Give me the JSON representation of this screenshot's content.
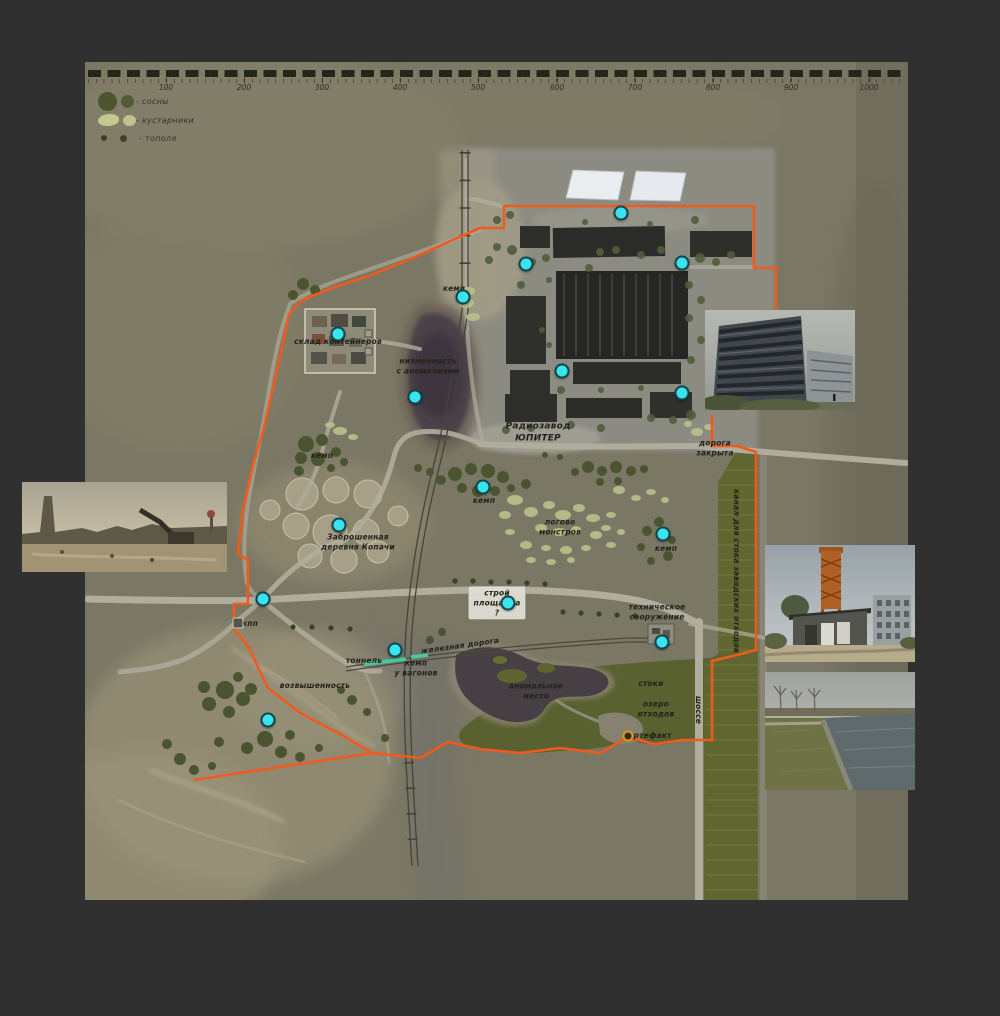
{
  "colors": {
    "background": "#303030",
    "map_base": "#7a7764",
    "boundary_orange": "#f05a1e",
    "poi_cyan": "#3ae4ef",
    "artifact_orange": "#e8920a",
    "canal_green": "#5f662f",
    "lake_dark": "#464044",
    "legend_pine": "#4c5530",
    "legend_shrub": "#c3ca8d",
    "legend_poplar": "#394126"
  },
  "scalebar": {
    "unit_labels": [
      {
        "label": "100",
        "x": 166
      },
      {
        "label": "200",
        "x": 244
      },
      {
        "label": "300",
        "x": 322
      },
      {
        "label": "400",
        "x": 400
      },
      {
        "label": "500",
        "x": 478
      },
      {
        "label": "600",
        "x": 557
      },
      {
        "label": "700",
        "x": 635
      },
      {
        "label": "800",
        "x": 713
      },
      {
        "label": "900",
        "x": 791
      },
      {
        "label": "1000",
        "x": 869
      }
    ]
  },
  "legend": {
    "items": [
      {
        "symbol": "pines",
        "label": "- сосны"
      },
      {
        "symbol": "shrubs",
        "label": "- кустарники"
      },
      {
        "symbol": "poplars",
        "label": "- тополя"
      }
    ]
  },
  "map": {
    "labels": [
      {
        "text": "кемп",
        "x": 454,
        "y": 289
      },
      {
        "text": "склад контейнеров",
        "x": 338,
        "y": 342
      },
      {
        "text": "низменность\nс аномалиями",
        "x": 428,
        "y": 366
      },
      {
        "text": "Радиозавод\nЮПИТЕР",
        "x": 538,
        "y": 433,
        "size": 9,
        "weight": 700
      },
      {
        "text": "дорога\nзакрыта",
        "x": 715,
        "y": 448
      },
      {
        "text": "кемп",
        "x": 322,
        "y": 456
      },
      {
        "text": "кемп",
        "x": 484,
        "y": 501
      },
      {
        "text": "логово\nмонстров",
        "x": 560,
        "y": 527
      },
      {
        "text": "Заброшенная\nдеревня Копачи",
        "x": 358,
        "y": 542
      },
      {
        "text": "кемп",
        "x": 666,
        "y": 549
      },
      {
        "text": "канал для стока заводских отходов",
        "x": 736,
        "y": 571,
        "rot": 90
      },
      {
        "text": "кпп",
        "x": 250,
        "y": 624
      },
      {
        "text": "строй\nплощадка\n?",
        "x": 497,
        "y": 603,
        "box": true
      },
      {
        "text": "техническое\nсооружение",
        "x": 657,
        "y": 612
      },
      {
        "text": "тоннель",
        "x": 364,
        "y": 661
      },
      {
        "text": "железная дорога",
        "x": 460,
        "y": 646,
        "rot": -8
      },
      {
        "text": "кемп\nу вагонов",
        "x": 416,
        "y": 668
      },
      {
        "text": "возвышенность",
        "x": 315,
        "y": 686
      },
      {
        "text": "аномальное\nместо",
        "x": 536,
        "y": 691
      },
      {
        "text": "стоки",
        "x": 651,
        "y": 684
      },
      {
        "text": "озеро\nотходов",
        "x": 656,
        "y": 709
      },
      {
        "text": "артефакт",
        "x": 650,
        "y": 736
      },
      {
        "text": "шоссе",
        "x": 698,
        "y": 710,
        "rot": 90
      }
    ],
    "points": [
      {
        "x": 621,
        "y": 213
      },
      {
        "x": 526,
        "y": 264
      },
      {
        "x": 682,
        "y": 263
      },
      {
        "x": 562,
        "y": 371
      },
      {
        "x": 682,
        "y": 393
      },
      {
        "x": 463,
        "y": 297
      },
      {
        "x": 338,
        "y": 334
      },
      {
        "x": 415,
        "y": 397
      },
      {
        "x": 483,
        "y": 487
      },
      {
        "x": 339,
        "y": 525
      },
      {
        "x": 663,
        "y": 534
      },
      {
        "x": 263,
        "y": 599
      },
      {
        "x": 508,
        "y": 603
      },
      {
        "x": 662,
        "y": 642
      },
      {
        "x": 395,
        "y": 650
      },
      {
        "x": 268,
        "y": 720
      }
    ],
    "artifact": {
      "x": 628,
      "y": 736
    },
    "checkpoint": {
      "x": 238,
      "y": 623
    }
  }
}
